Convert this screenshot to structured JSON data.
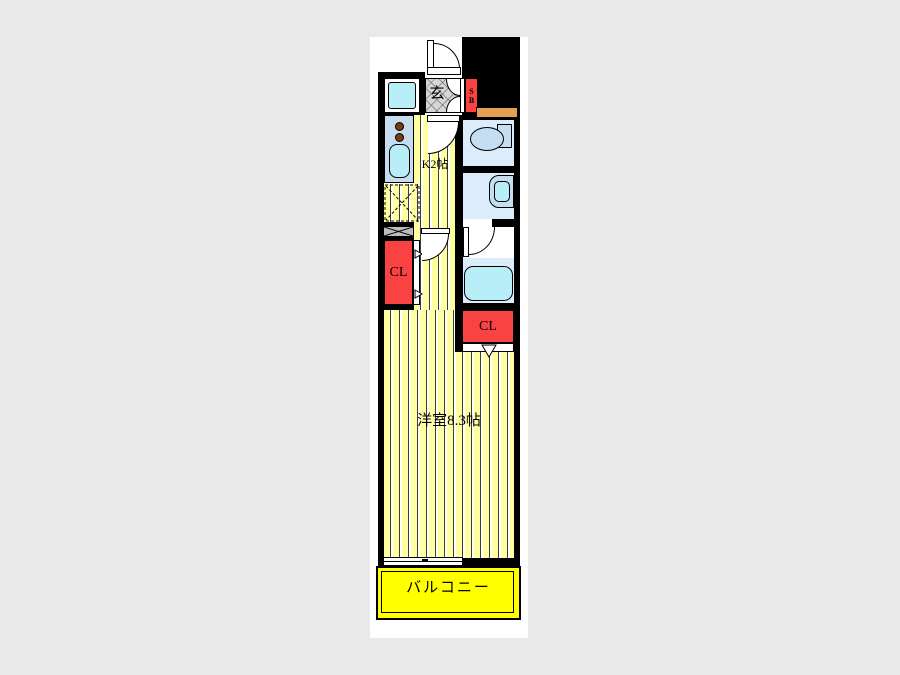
{
  "plan": {
    "title_hint": "studio apartment floor plan",
    "rooms": {
      "entrance_label": "玄",
      "shoe_box_line1": "S",
      "shoe_box_line2": "B",
      "kitchen_label": "K2帖",
      "closet_left_label": "CL",
      "closet_right_label": "CL",
      "main_room_label": "洋室8.3帖",
      "balcony_label": "バルコニー"
    },
    "colors": {
      "wall": "#000000",
      "floor_yellow": "#ffffa0",
      "balcony_yellow": "#ffff00",
      "closet_red": "#f94343",
      "room_blue": "#dcecfa",
      "fixture_blue": "#c6def2",
      "water_cyan": "#b8eef8",
      "counter_blue": "#c8dcf0",
      "shelf_orange": "#e0a050",
      "entrance_gray": "#d6d6d6",
      "page_background": "#e9e9e9",
      "sheet_background": "#ffffff"
    }
  }
}
